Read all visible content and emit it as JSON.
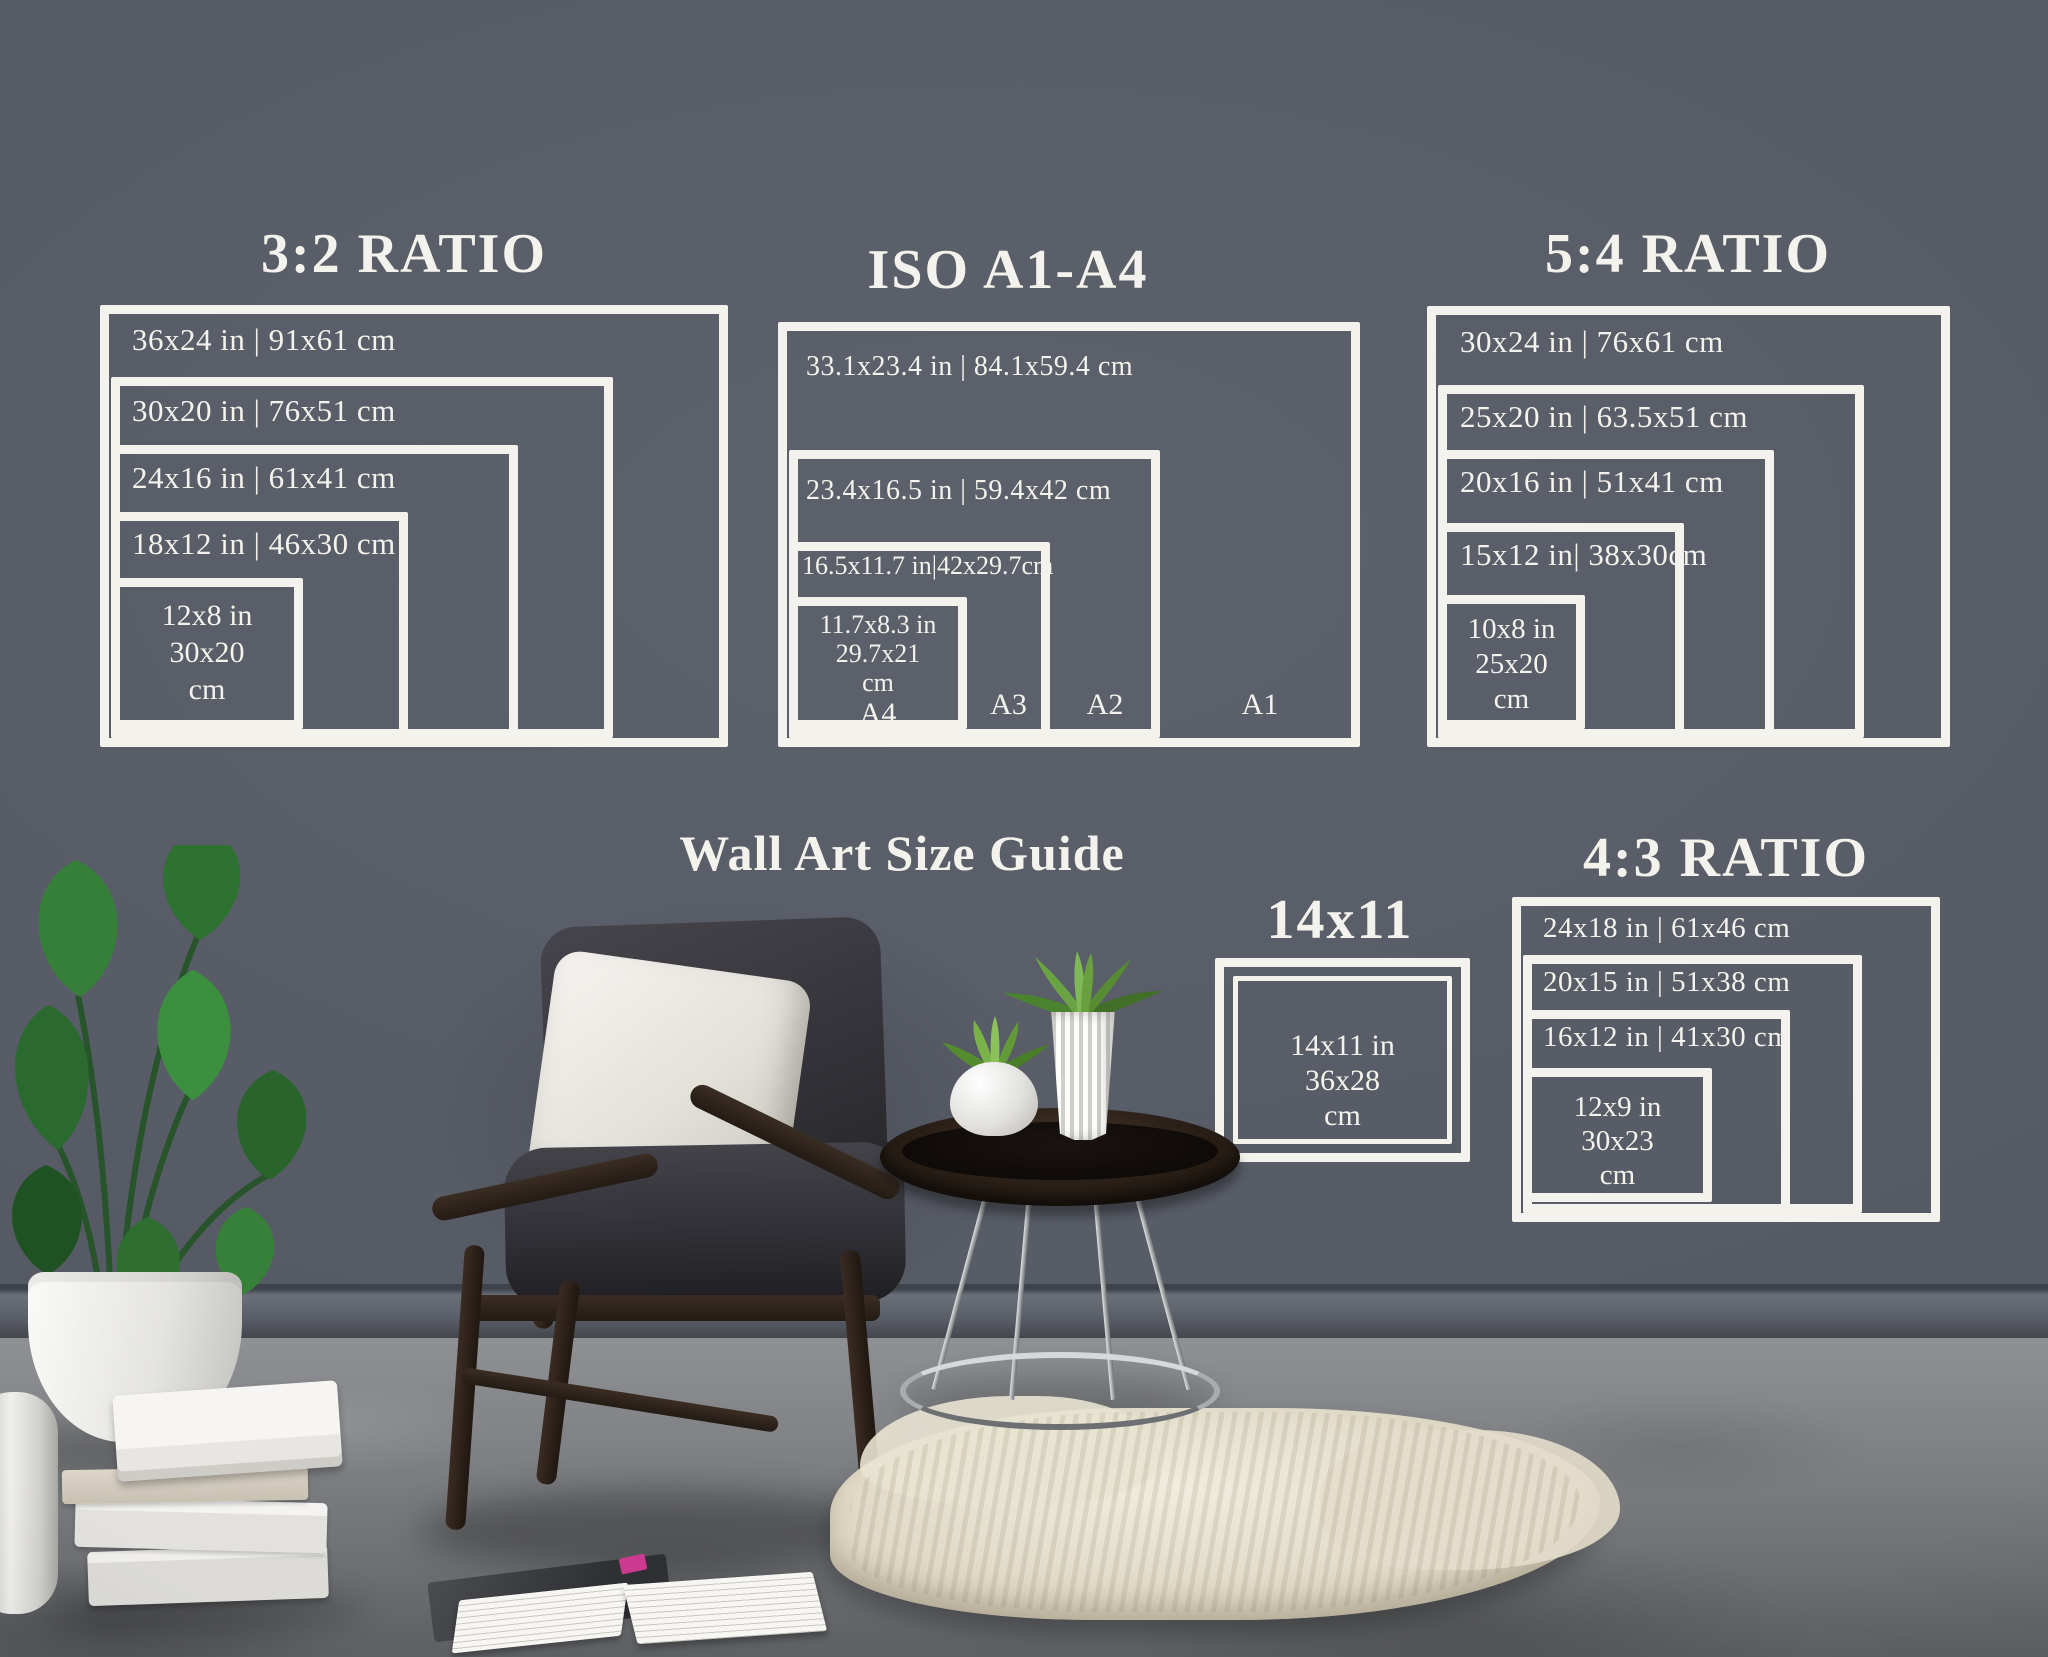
{
  "guide_title": "Wall Art Size Guide",
  "groups": {
    "r32": {
      "title": "3:2 RATIO",
      "rows": [
        "36x24 in | 91x61 cm",
        "30x20 in | 76x51 cm",
        "24x16 in | 61x41 cm",
        "18x12 in | 46x30 cm"
      ],
      "small": [
        "12x8 in",
        "30x20",
        "cm"
      ]
    },
    "iso": {
      "title": "ISO A1-A4",
      "rows": [
        "33.1x23.4 in | 84.1x59.4 cm",
        "23.4x16.5 in | 59.4x42 cm",
        "16.5x11.7 in|42x29.7cm"
      ],
      "small": [
        "11.7x8.3 in",
        "29.7x21",
        "cm",
        "A4"
      ],
      "corner_labels": [
        "A3",
        "A2",
        "A1"
      ]
    },
    "r54": {
      "title": "5:4 RATIO",
      "rows": [
        "30x24 in | 76x61 cm",
        "25x20 in | 63.5x51 cm",
        "20x16 in | 51x41 cm",
        "15x12 in| 38x30cm"
      ],
      "small": [
        "10x8 in",
        "25x20",
        "cm"
      ]
    },
    "s1411": {
      "title": "14x11",
      "small": [
        "14x11 in",
        "36x28",
        "cm"
      ]
    },
    "r43": {
      "title": "4:3 RATIO",
      "rows": [
        "24x18 in | 61x46 cm",
        "20x15 in | 51x38 cm",
        "16x12 in | 41x30 cm"
      ],
      "small": [
        "12x9 in",
        "30x23",
        "cm"
      ]
    }
  },
  "colors": {
    "wall": "#575b65",
    "line": "#f4f2ec",
    "floor": "#7f8184",
    "rug": "#e9e3d3",
    "plant_green": "#2f6b31",
    "wood": "#2c2119",
    "pink_accent": "#cb3a8e"
  }
}
